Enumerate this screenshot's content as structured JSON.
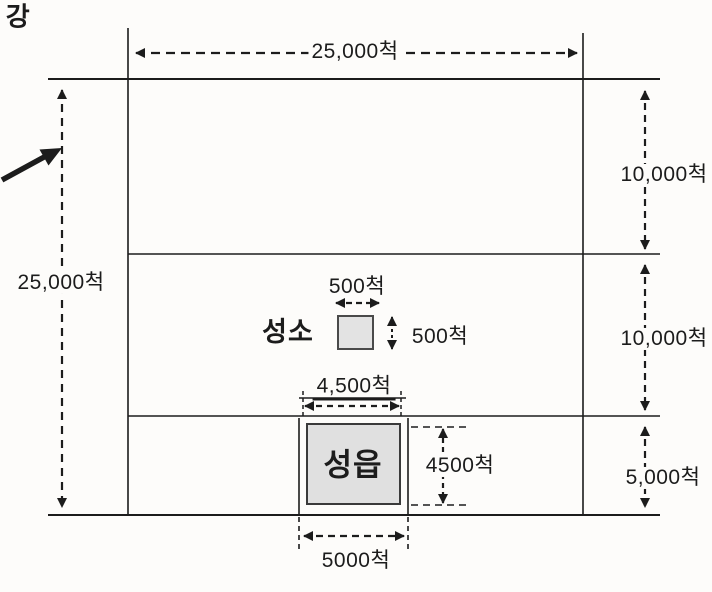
{
  "colors": {
    "paper": "#fdfcfa",
    "line": "#1c1c1c",
    "sanctuary_fill": "#e3e3e3",
    "city_fill": "#e0e0e0"
  },
  "river": {
    "label": "강"
  },
  "dims": {
    "top_width": "25,000척",
    "left_height": "25,000척",
    "band1_height": "10,000척",
    "band2_height": "10,000척",
    "band3_height": "5,000척"
  },
  "sanctuary": {
    "name": "성소",
    "width": "500척",
    "height": "500척"
  },
  "city": {
    "name": "성읍",
    "width": "4,500척",
    "height": "4500척",
    "block_width": "5000척"
  }
}
